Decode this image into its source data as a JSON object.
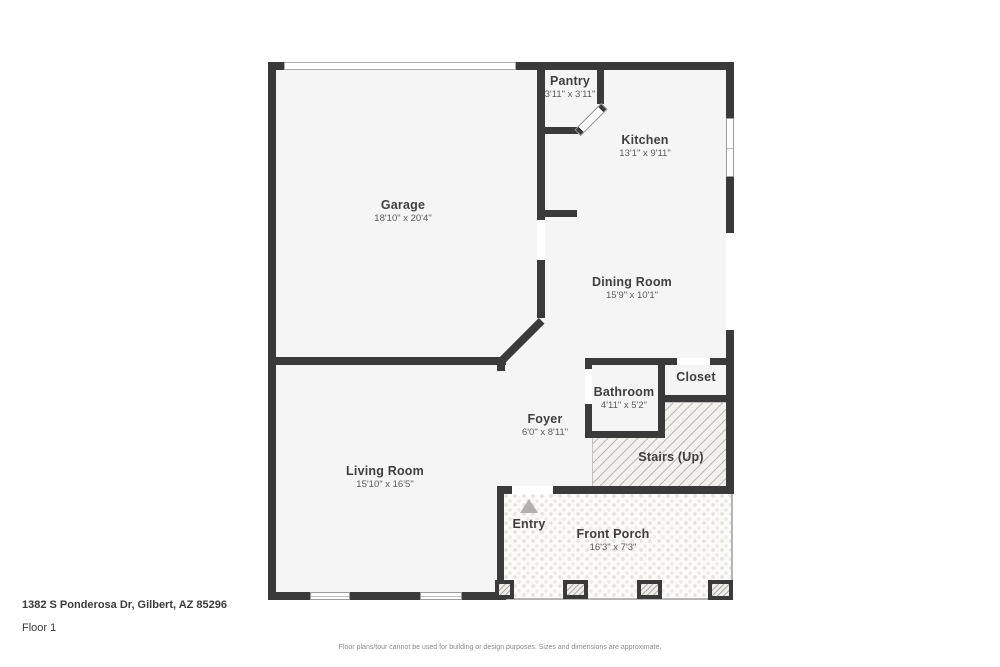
{
  "footer": {
    "address": "1382 S Ponderosa Dr, Gilbert, AZ 85296",
    "floor_label": "Floor 1",
    "disclaimer": "Floor plans/tour cannot be used for building or design purposes. Sizes and dimensions are approximate."
  },
  "colors": {
    "wall": "#3a3a3a",
    "floor": "#f5f5f5",
    "window_outline": "#9b9b9b",
    "hatch_line": "#8c8c8c",
    "porch_dot": "#e6e4e0",
    "entry_arrow": "#b2b0ad",
    "room_label": "#3f3f3f",
    "dim_label": "#5a5a5a"
  },
  "icons": {
    "entry_arrow": "triangle-up"
  },
  "rooms": [
    {
      "id": "garage",
      "name": "Garage",
      "dims": "18'10\" x 20'4\""
    },
    {
      "id": "pantry",
      "name": "Pantry",
      "dims": "3'11\" x 3'11\""
    },
    {
      "id": "kitchen",
      "name": "Kitchen",
      "dims": "13'1\" x 9'11\""
    },
    {
      "id": "dining-room",
      "name": "Dining Room",
      "dims": "15'9\" x 10'1\""
    },
    {
      "id": "bathroom",
      "name": "Bathroom",
      "dims": "4'11\" x 5'2\""
    },
    {
      "id": "closet",
      "name": "Closet",
      "dims": ""
    },
    {
      "id": "stairs",
      "name": "Stairs (Up)",
      "dims": ""
    },
    {
      "id": "foyer",
      "name": "Foyer",
      "dims": "6'0\" x 8'11\""
    },
    {
      "id": "living-room",
      "name": "Living Room",
      "dims": "15'10\" x 16'5\""
    },
    {
      "id": "entry",
      "name": "Entry",
      "dims": ""
    },
    {
      "id": "front-porch",
      "name": "Front Porch",
      "dims": "16'3\" x 7'3\""
    }
  ]
}
